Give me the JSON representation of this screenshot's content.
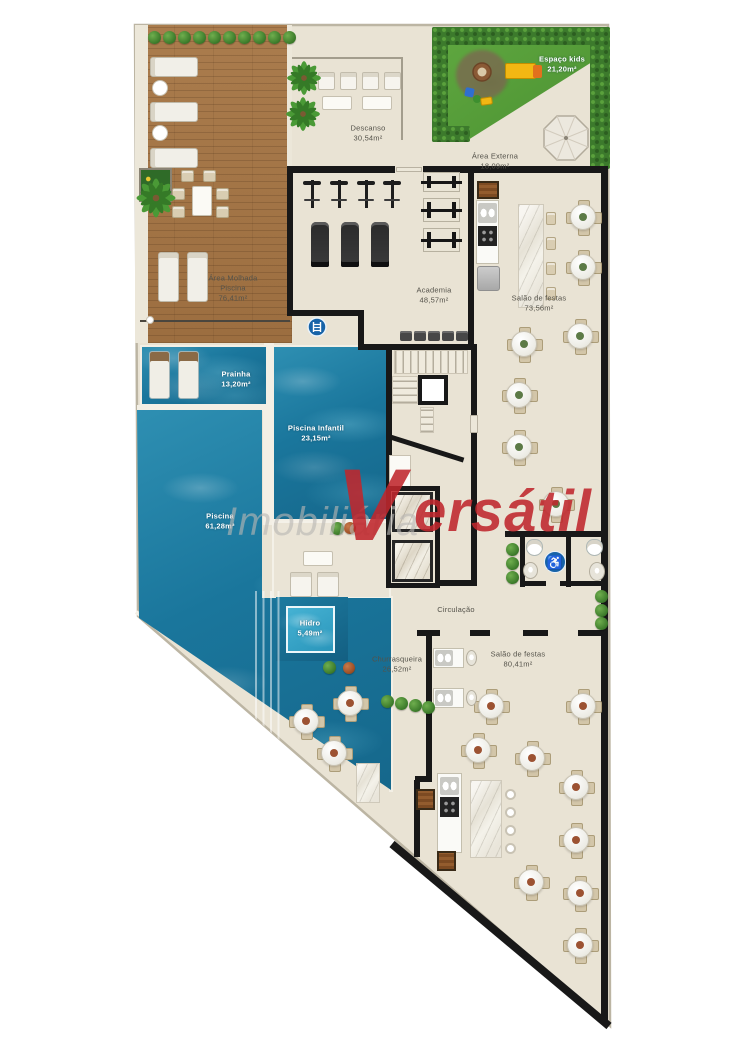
{
  "rooms": {
    "area_molhada": {
      "l1": "Área Molhada",
      "l2": "Piscina",
      "area": "76,41m²"
    },
    "descanso": {
      "l1": "Descanso",
      "area": "30,54m²"
    },
    "espaco_kids": {
      "l1": "Espaço kids",
      "area": "21,20m²"
    },
    "area_externa": {
      "l1": "Área Externa",
      "area": "18,09m²"
    },
    "academia": {
      "l1": "Academia",
      "area": "48,57m²"
    },
    "salao_festas_1": {
      "l1": "Salão de festas",
      "area": "73,56m²"
    },
    "prainha": {
      "l1": "Prainha",
      "area": "13,20m²"
    },
    "piscina_infantil": {
      "l1": "Piscina Infantil",
      "area": "23,15m²"
    },
    "piscina": {
      "l1": "Piscina",
      "area": "61,28m²"
    },
    "hidro": {
      "l1": "Hidro",
      "area": "5,49m²"
    },
    "circulacao": {
      "l1": "Circulação"
    },
    "churrasqueira": {
      "l1": "Churrasqueira",
      "area": "26,52m²"
    },
    "salao_festas_2": {
      "l1": "Salão de festas",
      "area": "80,41m²"
    }
  },
  "watermark": {
    "part1": "Imobiliária",
    "initial": "V",
    "rest": "ersátil"
  },
  "badges": {
    "accessibility": "♿"
  },
  "colors": {
    "accent_red": "#c0272d",
    "water": "#1f7ea4",
    "grass": "#58a33e",
    "wood": "#a87a4b",
    "wall": "#1a1a1a",
    "floor": "#e9e3d4"
  }
}
